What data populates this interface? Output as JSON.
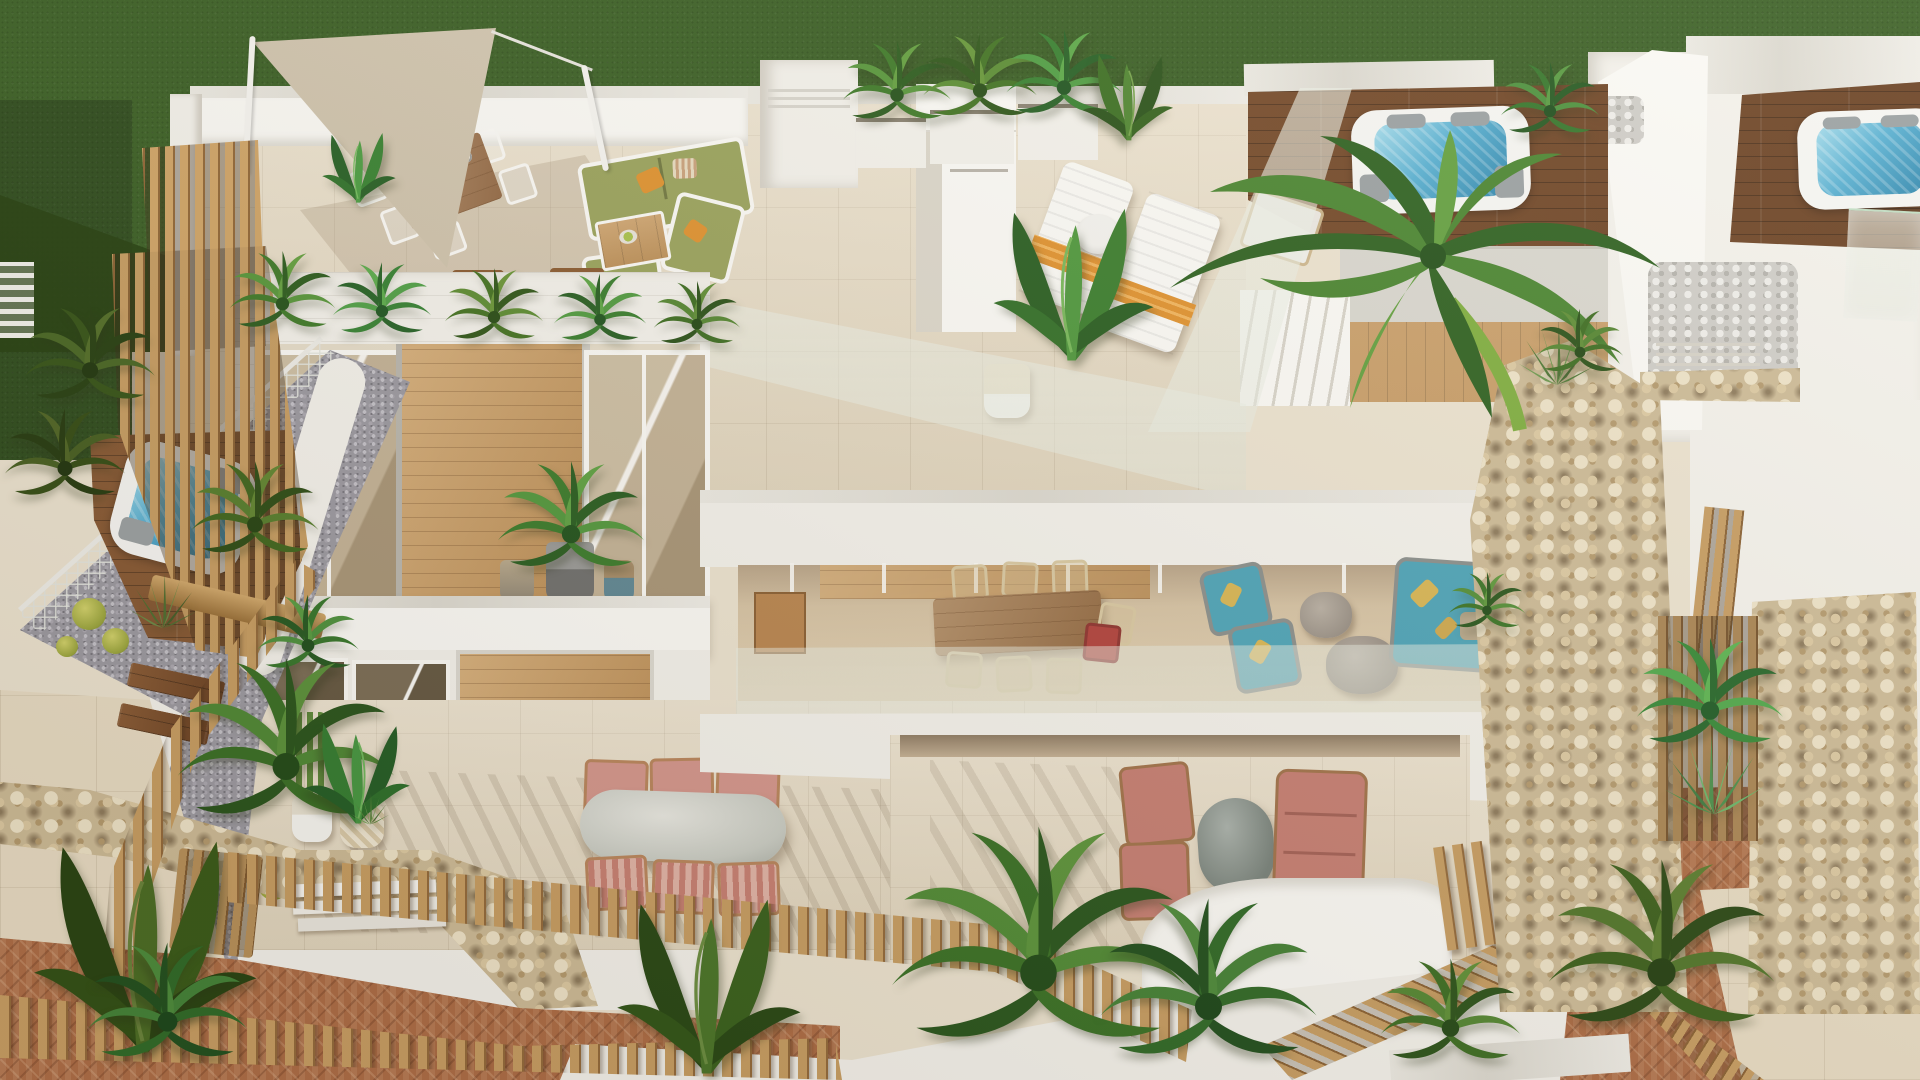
{
  "scene": {
    "title": "Aerial 3D rendering of modern Mediterranean villas",
    "description": "Bird's-eye 3D architectural rendering of white modern villas: rooftop terrace with triangular shade sail, outdoor dining set with plates, olive-green sofa set, two sun loungers with orange towels, three rooftop jacuzzis on dark wooden decks, glass balustrades, balconies with tinted sliding windows and wood-clad panels, an upper terrace with rattan dining chairs, teal rope lounge chairs and stone coffee tables, ground terraces with dusty-pink dining and lounge sets, dry-stone pillars, a tall palm tree, wooden slat screens and picket fences, a plunge pool, barrel cacti, gravel and herringbone brick paths, and a deep green lawn.",
    "objects": [
      {
        "name": "lawn",
        "color": "#3a5f24"
      },
      {
        "name": "shade-sail",
        "color": "#cec2ab"
      },
      {
        "name": "rooftop-dining-set",
        "plates": 6,
        "chair_color": "#ffffff"
      },
      {
        "name": "rooftop-sofa-set",
        "cushion_color": "#9aa35c",
        "pillow_color": "#e0922f"
      },
      {
        "name": "wooden-coffee-table",
        "detail": "fruit bowl"
      },
      {
        "name": "side-stools",
        "count": 2
      },
      {
        "name": "chimney-stacks",
        "count": 2,
        "detail": "horizontal vent slots"
      },
      {
        "name": "sun-loungers",
        "count": 2,
        "towel_color": "#e0922f"
      },
      {
        "name": "lounger-side-table",
        "color": "#ffffff"
      },
      {
        "name": "rooftop-jacuzzis",
        "count": 3,
        "water_color": "#58b0d2"
      },
      {
        "name": "wooden-jacuzzi-decks",
        "color": "#7b4b28"
      },
      {
        "name": "glass-balustrades"
      },
      {
        "name": "roof-stairs"
      },
      {
        "name": "balcony-windows",
        "glass_tint": "#c3b296"
      },
      {
        "name": "wood-clad-panel",
        "color": "#c99a5f"
      },
      {
        "name": "balcony-potted-plants",
        "count": 3
      },
      {
        "name": "upper-terrace-dining",
        "detail": "rattan chairs, long wooden table, one red chair"
      },
      {
        "name": "teal-lounge-set",
        "cushion_color": "#4da4b8",
        "pillow_color": "#d8b654"
      },
      {
        "name": "stone-coffee-tables",
        "count": 2
      },
      {
        "name": "pink-dining-set",
        "chairs": 6,
        "color": "#d4968c",
        "table": "oval stone"
      },
      {
        "name": "pink-lounge-set",
        "armchairs": 2,
        "sofa": 1,
        "color": "#c67e72"
      },
      {
        "name": "dry-stone-pillars",
        "count": 2,
        "color": "#cdbb97"
      },
      {
        "name": "palm-tree"
      },
      {
        "name": "wooden-slat-screens"
      },
      {
        "name": "picket-fences",
        "color": "#c79d62"
      },
      {
        "name": "wooden-pergola"
      },
      {
        "name": "plunge-pool",
        "water_color": "#58b0d2"
      },
      {
        "name": "mesh-fence"
      },
      {
        "name": "barrel-cacti",
        "count": 6,
        "color": "#b9b94d"
      },
      {
        "name": "stone-retaining-wall"
      },
      {
        "name": "brick-paths",
        "color": "#ad6c45"
      },
      {
        "name": "gravel-path",
        "color": "#9b99a1"
      },
      {
        "name": "pebble-beds",
        "color": "#cfcdc8"
      },
      {
        "name": "neighbour-villa-rooftop",
        "detail": "second jacuzzi deck at right edge"
      }
    ]
  },
  "palette": {
    "grass": "#3a5f24",
    "grass_shadow": "#24400f",
    "sand": "#ece3d0",
    "tile": "#e8dcc4",
    "wall": "#f4f2ec",
    "wall_bright": "#fbfaf6",
    "wall_shadow": "#dcd7cb",
    "deck_dark": "#7b4b28",
    "wood_light": "#c99a5f",
    "wood_slat": "#c79d62",
    "water": "#58b0d2",
    "water_deep": "#2f86ad",
    "stone": "#cdbb97",
    "brick": "#ad6c45",
    "gravel": "#9b99a1",
    "pebble": "#cfcdc8",
    "olive": "#9aa35c",
    "orange": "#e0922f",
    "teal": "#4da4b8",
    "pink": "#c67e72",
    "pink_light": "#d4968c",
    "sail": "#cec2ab",
    "foliage": "#3e7028"
  }
}
